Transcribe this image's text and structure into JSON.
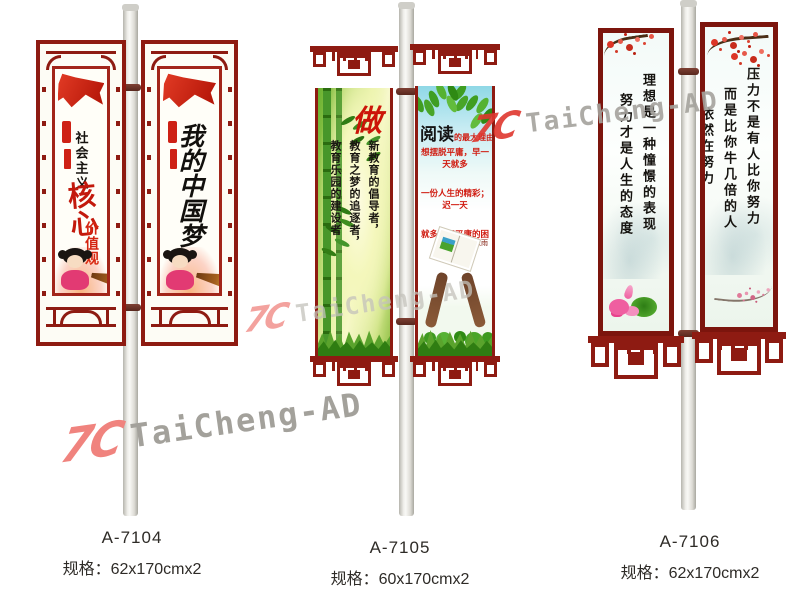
{
  "image_type": "street-light-pole-banner product catalog",
  "brand_watermark": {
    "logo": "7C",
    "name": "TaiCheng-AD"
  },
  "colors": {
    "frame_red": "#8e1b12",
    "flag_red": "#d8271b",
    "watermark_pink": "#f0837e",
    "watermark_red": "#df372e",
    "watermark_gray": "#a3a19b"
  },
  "products": [
    {
      "code": "A-7104",
      "spec": "规格：62x170cmx2",
      "frame_style": "traditional-lattice-full-frame",
      "banners": [
        {
          "heading": "社会主义",
          "title": "核心",
          "subtitle": "价值观",
          "artwork": "red-flag, red-seal, dream-doll-girl, golden-horn"
        },
        {
          "calligraphy": "我的中国梦",
          "artwork": "red-flag, red-seal, dream-doll-girl, golden-horn"
        }
      ]
    },
    {
      "code": "A-7105",
      "spec": "规格：60x170cmx2",
      "frame_style": "lattice-header-and-footer",
      "banners": [
        {
          "big_char": "做",
          "columns": [
            "新教育的倡导者，",
            "教育之梦的追逐者，",
            "教育乐园的建设者"
          ],
          "artwork": "bamboo, grass"
        },
        {
          "title": "阅读",
          "title_rest": "的最大理由是",
          "lines": [
            "想摆脱平庸，早一天就多",
            "一份人生的精彩；迟一天",
            "就多一天平庸的困扰。"
          ],
          "signature": "——余秋雨",
          "artwork": "green-leaves, hands-holding-open-book, grass"
        }
      ]
    },
    {
      "code": "A-7106",
      "spec": "规格：62x170cmx2",
      "frame_style": "plain-frame-with-lattice-footer",
      "banners": [
        {
          "columns": [
            "理想是一种憧憬的表现",
            "努力才是人生的态度"
          ],
          "artwork": "plum-blossom-top, lotus-bottom"
        },
        {
          "columns": [
            "压力不是有人比你努力",
            "而是比你牛几倍的人",
            "依然在努力"
          ],
          "artwork": "plum-blossom-top, plum-branch-bottom"
        }
      ]
    }
  ]
}
